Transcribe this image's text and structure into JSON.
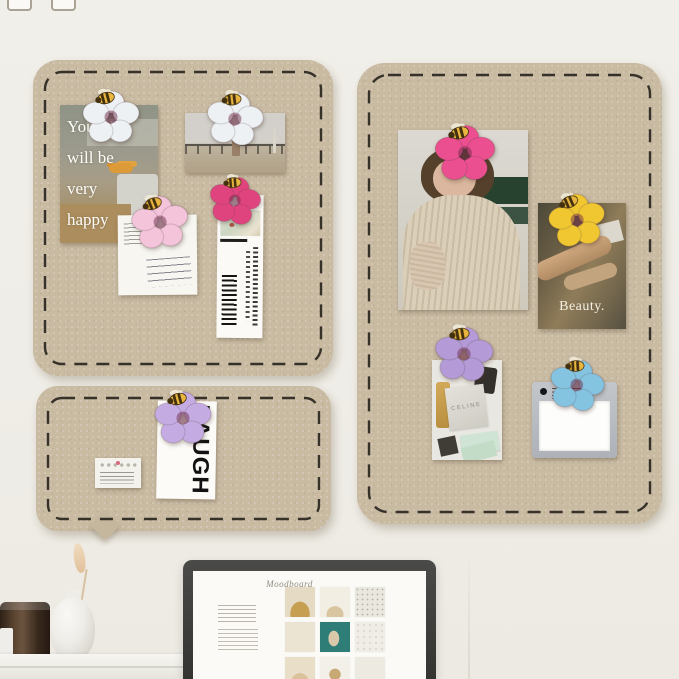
{
  "page": {
    "type": "product-photo",
    "subject": "Three khaki felt memo boards with stitched dashed borders mounted on a wall, decorated with flower-and-bee push pins holding photo cards, notes and bookmarks, above a desk with a candle jar, vase and a monitor showing a moodboard page"
  },
  "texts": {
    "kitchen_card_lines": [
      "Your life",
      "will be",
      "very",
      "happy"
    ],
    "beauty_card": "Beauty.",
    "laugh_card": "LAUGH",
    "fashion_brand": "CELINE",
    "screen_title": "Moodboard"
  },
  "colors": {
    "wall": "#f0eee8",
    "board": "#c9baa2",
    "stitch": "#36322a",
    "bee_body": "#e9b63f",
    "pin_white": "#eef1f3",
    "pin_light_pink": "#f3c4da",
    "pin_deep_pink": "#e0447e",
    "pin_hot_pink": "#ec4f90",
    "pin_yellow": "#f0c731",
    "pin_purple": "#b49bd8",
    "pin_blue": "#85c4e1",
    "pin_lilac": "#c4ace2"
  },
  "pins": [
    {
      "location": "kitchen-photo-card",
      "color_name": "white"
    },
    {
      "location": "beach-photo",
      "color_name": "white"
    },
    {
      "location": "handwritten-note",
      "color_name": "light-pink"
    },
    {
      "location": "bookmark",
      "color_name": "deep-pink"
    },
    {
      "location": "portrait-photo",
      "color_name": "hot-pink"
    },
    {
      "location": "beauty-card",
      "color_name": "yellow"
    },
    {
      "location": "fashion-photo",
      "color_name": "purple"
    },
    {
      "location": "notepad",
      "color_name": "blue"
    },
    {
      "location": "laugh-card",
      "color_name": "lilac"
    }
  ]
}
